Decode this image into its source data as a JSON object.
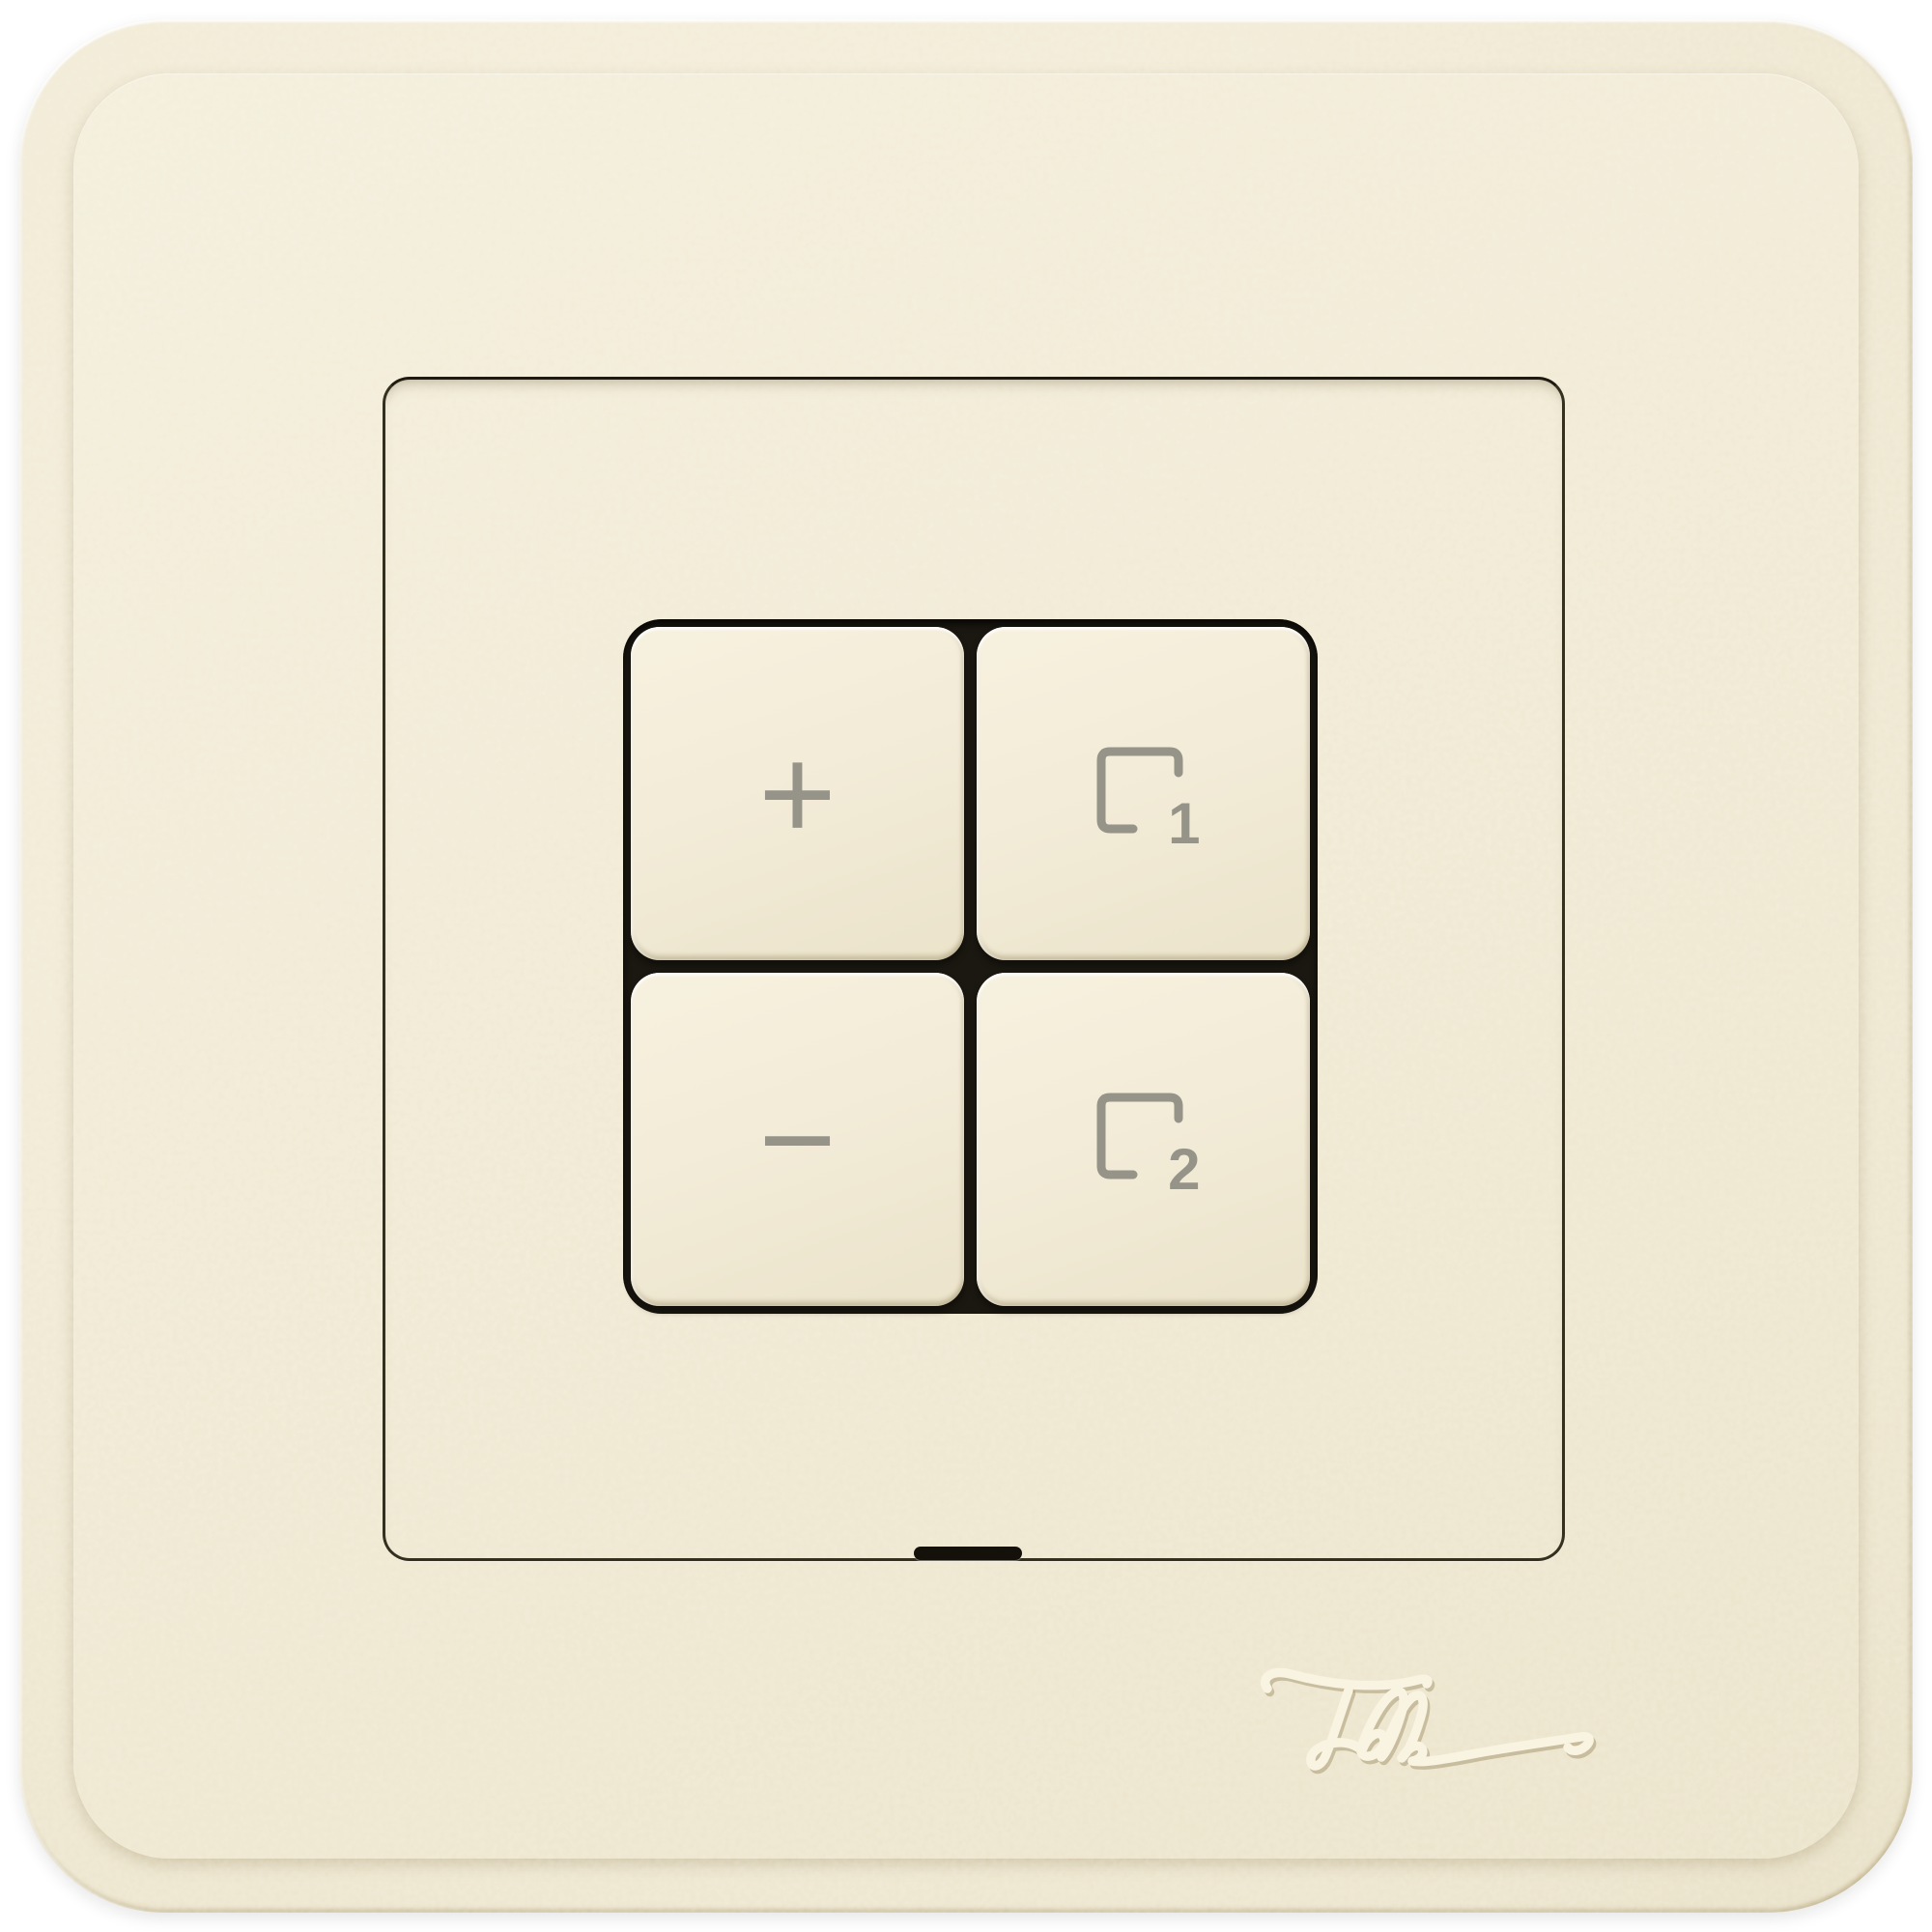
{
  "brand": {
    "logo_text": "Feller"
  },
  "buttons": {
    "dim_up": {
      "glyph": "+"
    },
    "dim_down": {
      "glyph": "−"
    },
    "scene_1": {
      "number": "1"
    },
    "scene_2": {
      "number": "2"
    }
  },
  "icons": {
    "scene_frame": "open-square-outline",
    "dim_up": "plus-icon",
    "dim_down": "minus-icon"
  },
  "colors": {
    "plate_cream": "#f0e9d4",
    "button_face": "#f2ecd8",
    "icon_gray": "#969388",
    "seam_dark": "#2b2719",
    "recess_dark": "#1b1811",
    "background": "#ffffff"
  }
}
